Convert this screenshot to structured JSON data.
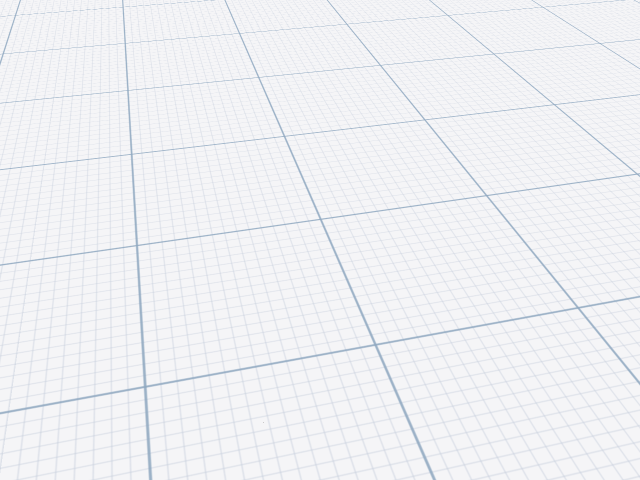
{
  "view": {
    "type": "3d-room-planner-viewport",
    "camera": "overhead-oblique",
    "room": "bedroom"
  },
  "colors": {
    "backdrop": "#f5f5f7",
    "grid_minor": "#c6cedc",
    "grid_major": "#8fa8c0",
    "wall_left": "#c3c0bd",
    "wall_back": "#cdcac7",
    "wall_top_edge": "#e5e3e1",
    "wall_end_left": "#dfddda",
    "wall_end_cap": "#f0eeeb",
    "floor": "#f1eee6",
    "floor_grout": "#dcd8cf",
    "duvet": "#cfe3e3",
    "duvet_fold": "#e0efef",
    "bed_wood": "#6b4a35",
    "bed_wood_top": "#7d593f",
    "bed_rail": "#5c3e2c",
    "headboard": "#2e1f17",
    "headboard_edge": "#5d4030",
    "pillow": "#ece5d3",
    "pillow_seam": "#d8d0bc",
    "shelf": "#291a12",
    "shelf_edge": "#1a0f09",
    "tv_screen": "#1e1e1e",
    "tv_bezel": "#0c0c0c",
    "petal": "#f2c21d",
    "flower_center": "#54400f",
    "leaf": "#6a8a3a",
    "vase": "#c9cdd8",
    "vase_line": "#aeb2c0",
    "frame": "#1f1711",
    "frame_dots": "#cfcabe",
    "door_wood": "#c7ab7a",
    "door_wood_light": "#ddc79b",
    "door_glass": "#b9c3d2",
    "door_handle": "#9a9a98",
    "doorway_dark": "#0d0d0d",
    "dresser_top": "#fbfbf9",
    "dresser_front": "#ebebe9",
    "dresser_side": "#dfdfdd",
    "dresser_seam": "#ffffff",
    "chair_back": "#4a4544",
    "chair_frame": "#c8c8c7"
  },
  "scene": {
    "objects": [
      {
        "name": "left-wall",
        "type": "wall"
      },
      {
        "name": "back-wall",
        "type": "wall"
      },
      {
        "name": "room-floor",
        "type": "floor",
        "finish": "tile"
      },
      {
        "name": "double-bed",
        "type": "bed",
        "parts": "headboard, pillows, duvet, side-rail, footboard"
      },
      {
        "name": "wall-shelf",
        "type": "shelf"
      },
      {
        "name": "sunflower-vase-left",
        "type": "plant"
      },
      {
        "name": "sunflower-vase-right",
        "type": "plant"
      },
      {
        "name": "flat-screen-tv",
        "type": "tv"
      },
      {
        "name": "picture-frame",
        "type": "decor"
      },
      {
        "name": "door",
        "type": "door",
        "state": "open",
        "glass_panes": 3
      },
      {
        "name": "dresser",
        "type": "storage"
      },
      {
        "name": "desk-chair",
        "type": "chair"
      }
    ]
  }
}
